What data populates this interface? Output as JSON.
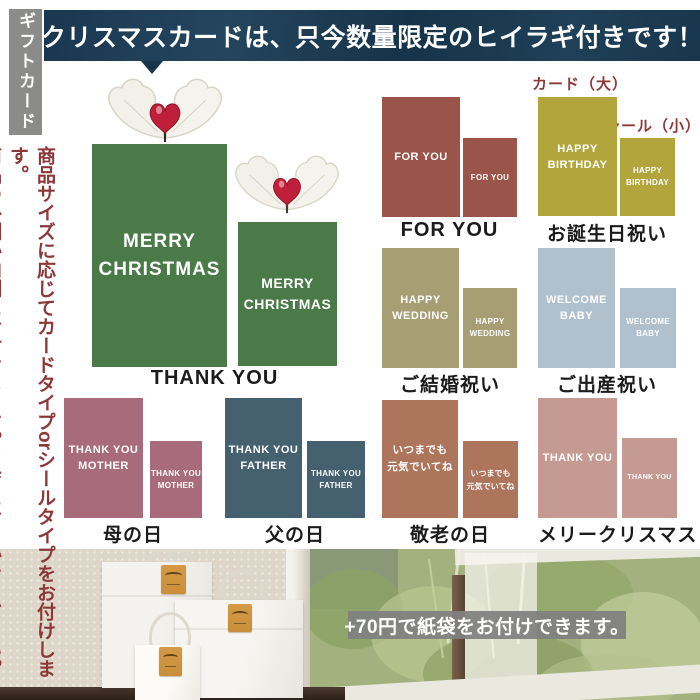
{
  "top_banner": {
    "text": "クリスマスカードは、只今数量限定のヒイラギ付きです！",
    "bg": "#1b3950"
  },
  "sidebar": {
    "tag": "ギフトカード",
    "note_col1": "商品サイズに応じてカードタイプorシールタイプをお付けします。",
    "note_col2": "商品の外側か内側にお付けします。当店におまかせください。",
    "note_color": "#8c3839"
  },
  "annotations": {
    "card_large": "カード（大）",
    "seal_small": "シール（小）"
  },
  "sections": {
    "christmas": {
      "line1": "MERRY",
      "line2": "CHRISTMAS",
      "label": "THANK YOU",
      "color": "#4b7a49"
    },
    "for_you": {
      "line1": "FOR YOU",
      "label": "FOR YOU",
      "color": "#9b5449"
    },
    "birthday": {
      "line1": "HAPPY",
      "line2": "BIRTHDAY",
      "label": "お誕生日祝い",
      "color": "#b2a53c"
    },
    "wedding": {
      "line1": "HAPPY",
      "line2": "WEDDING",
      "label": "ご結婚祝い",
      "color": "#a79e74"
    },
    "baby": {
      "line1": "WELCOME",
      "line2": "BABY",
      "label": "ご出産祝い",
      "color": "#b0c0cd"
    },
    "mother": {
      "line1": "THANK YOU",
      "line2": "MOTHER",
      "label": "母の日",
      "color": "#a76b7c"
    },
    "father": {
      "line1": "THANK YOU",
      "line2": "FATHER",
      "label": "父の日",
      "color": "#45606f"
    },
    "respect": {
      "line1": "いつまでも",
      "line2": "元気でいてね",
      "label": "敬老の日",
      "color": "#ad755b"
    },
    "merry": {
      "line1": "THANK YOU",
      "label": "メリークリスマス",
      "color": "#c49a92"
    }
  },
  "photo": {
    "banner_text": "+70円で紙袋をお付けできます。"
  }
}
